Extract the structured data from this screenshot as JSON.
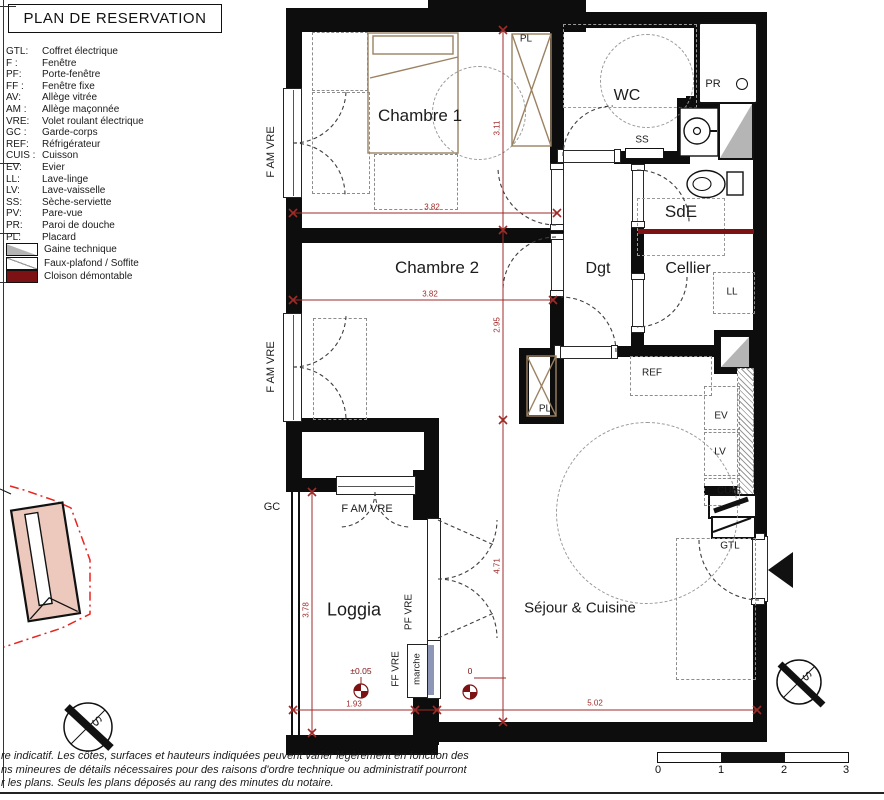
{
  "title": "PLAN DE RESERVATION",
  "legend": {
    "items": [
      {
        "abbr": "GTL:",
        "label": "Coffret électrique"
      },
      {
        "abbr": "F :",
        "label": "Fenêtre"
      },
      {
        "abbr": "PF:",
        "label": "Porte-fenêtre"
      },
      {
        "abbr": "FF :",
        "label": "Fenêtre fixe"
      },
      {
        "abbr": "AV:",
        "label": "Allège vitrée"
      },
      {
        "abbr": "AM :",
        "label": "Allège maçonnée"
      },
      {
        "abbr": "VRE:",
        "label": "Volet roulant électrique"
      },
      {
        "abbr": "GC :",
        "label": "Garde-corps"
      },
      {
        "abbr": "REF:",
        "label": "Réfrigérateur"
      },
      {
        "abbr": "CUIS :",
        "label": "Cuisson"
      },
      {
        "abbr": "EV:",
        "label": "Evier"
      },
      {
        "abbr": "LL:",
        "label": "Lave-linge"
      },
      {
        "abbr": "LV:",
        "label": "Lave-vaisselle"
      },
      {
        "abbr": "SS:",
        "label": "Sèche-serviette"
      },
      {
        "abbr": "PV:",
        "label": "Pare-vue"
      },
      {
        "abbr": "PR:",
        "label": "Paroi de douche"
      },
      {
        "abbr": "PL:",
        "label": "Placard"
      }
    ],
    "swatches": [
      {
        "name": "gaine-technique",
        "label": "Gaine technique"
      },
      {
        "name": "faux-plafond",
        "label": "Faux-plafond / Soffite"
      },
      {
        "name": "cloison-demontable",
        "label": "Cloison démontable"
      }
    ]
  },
  "rooms": {
    "chambre1": "Chambre 1",
    "chambre2": "Chambre 2",
    "wc": "WC",
    "sde": "SdE",
    "dgt": "Dgt",
    "cellier": "Cellier",
    "loggia": "Loggia",
    "sejour": "Séjour & Cuisine"
  },
  "labels": {
    "pl_chambre1": "PL",
    "pl_sejour": "PL",
    "ss": "SS",
    "pr": "PR",
    "ref": "REF",
    "ev": "EV",
    "lv": "LV",
    "cuis": "CUIS",
    "ll": "LL",
    "gtl": "GTL",
    "gc": "GC",
    "f_am_vre": "F AM VRE",
    "pf_vre": "PF VRE",
    "ff_vre": "FF VRE",
    "marche": "marche"
  },
  "dimensions": {
    "chambre1_width": "3.82",
    "chambre1_height": "3.11",
    "chambre2_width": "3.82",
    "chambre2_height": "2.95",
    "sejour_height": "4.71",
    "loggia_height": "3.78",
    "loggia_width": "1.93",
    "sejour_width": "5.02"
  },
  "levels": {
    "loggia": "±0.05",
    "sejour": "0"
  },
  "compass": {
    "south": "S"
  },
  "scale_bar": {
    "ticks": [
      "0",
      "1",
      "2",
      "3"
    ]
  },
  "disclaimer": {
    "line1": "re indicatif. Les côtes, surfaces et hauteurs indiquées peuvent varier légèrement en fonction des",
    "line2": "ns mineures de détails nécessaires pour des raisons d'ordre technique ou administratif pourront",
    "line3": "r les plans. Seuls les plans déposés au rang des minutes du notaire."
  },
  "colors": {
    "wall": "#0d0d0d",
    "dimension_red": "#9e2b28",
    "dark_red": "#7d1214",
    "furniture_brown": "#9b8262",
    "gaine_gray": "#b5b5b5",
    "site_pink": "#ecc9bc",
    "site_red": "#e8251f"
  }
}
